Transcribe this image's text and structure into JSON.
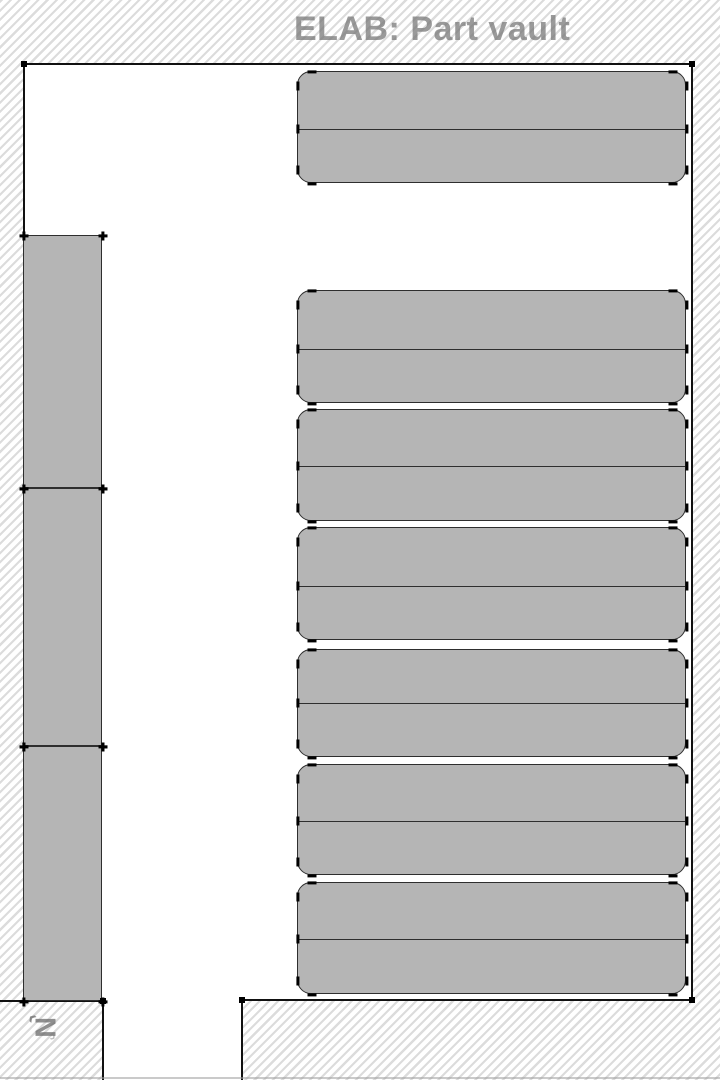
{
  "title": "ELAB: Part vault",
  "compass": {
    "label": "N",
    "arrow_front": "‹",
    "arrow_back": "›"
  },
  "colors": {
    "hatch_line": "#dcdcdc",
    "background": "#ffffff",
    "shelf_fill": "#b5b5b5",
    "shelf_outline": "#2e2e2e",
    "wall_line": "#111111",
    "node_marker": "#000000",
    "title_text": "#787878"
  },
  "map": {
    "white_areas": [
      {
        "x": 24,
        "y": 64,
        "w": 668,
        "h": 936
      },
      {
        "x": 103,
        "y": 1000,
        "w": 139,
        "h": 80
      }
    ],
    "walls": [
      [
        24,
        64,
        692,
        64
      ],
      [
        24,
        64,
        24,
        236
      ],
      [
        692,
        64,
        692,
        1000
      ],
      [
        242,
        1000,
        692,
        1000
      ],
      [
        242,
        1000,
        242,
        1080
      ],
      [
        0,
        1001,
        103,
        1001
      ],
      [
        103,
        1001,
        103,
        1080
      ]
    ],
    "wall_nodes": [
      [
        24,
        64
      ],
      [
        692,
        64
      ],
      [
        692,
        1000
      ],
      [
        242,
        1000
      ],
      [
        103,
        1001
      ]
    ],
    "shelf_rows": [
      {
        "x": 297,
        "y": 71,
        "w": 389,
        "h": 112,
        "divider_y": 128,
        "r": 14
      },
      {
        "x": 297,
        "y": 290,
        "w": 389,
        "h": 113,
        "divider_y": 348,
        "r": 14
      },
      {
        "x": 297,
        "y": 409,
        "w": 389,
        "h": 112,
        "divider_y": 465,
        "r": 14
      },
      {
        "x": 297,
        "y": 527,
        "w": 389,
        "h": 113,
        "divider_y": 585,
        "r": 14
      },
      {
        "x": 297,
        "y": 649,
        "w": 389,
        "h": 108,
        "divider_y": 702,
        "r": 14
      },
      {
        "x": 297,
        "y": 764,
        "w": 389,
        "h": 111,
        "divider_y": 820,
        "r": 14
      },
      {
        "x": 297,
        "y": 882,
        "w": 389,
        "h": 112,
        "divider_y": 938,
        "r": 14
      }
    ],
    "wall_racks": [
      {
        "x": 23,
        "y": 235,
        "w": 79,
        "h": 253
      },
      {
        "x": 23,
        "y": 488,
        "w": 79,
        "h": 258
      },
      {
        "x": 23,
        "y": 746,
        "w": 79,
        "h": 255
      }
    ]
  }
}
